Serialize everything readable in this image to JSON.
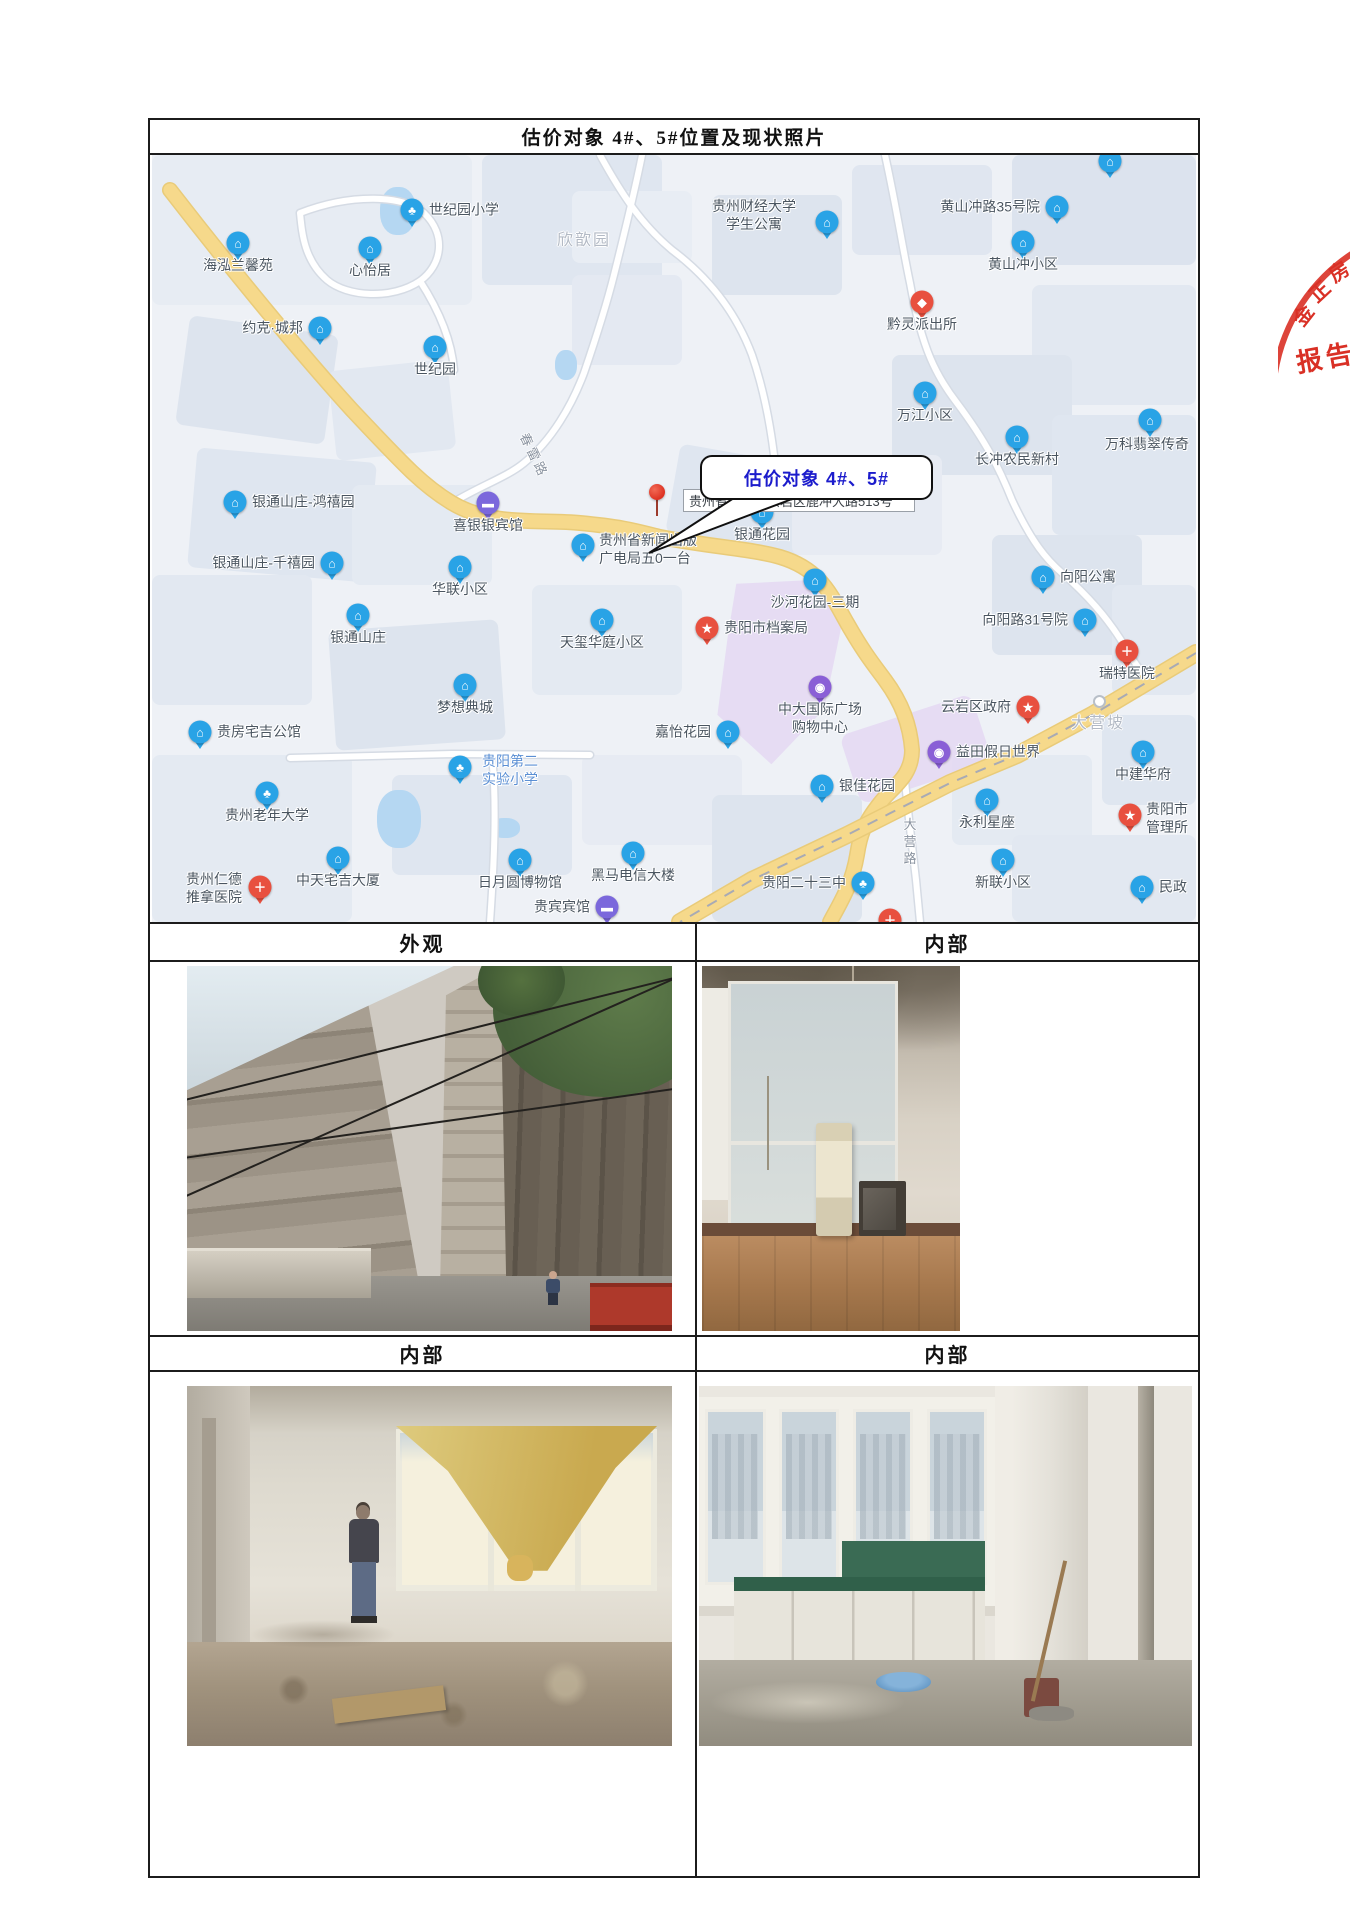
{
  "title": "估价对象 4#、5#位置及现状照片",
  "photo_sections": [
    {
      "label": "外观"
    },
    {
      "label": "内部"
    },
    {
      "label": "内部"
    },
    {
      "label": "内部"
    }
  ],
  "map": {
    "callout_text": "估价对象 4#、5#",
    "address_label": "贵州省贵阳市云岩区鹿冲大路513号",
    "area_labels": [
      {
        "text": "欣歆园",
        "x": 432,
        "y": 83
      },
      {
        "text": "大营坡",
        "x": 946,
        "y": 566
      }
    ],
    "road_labels": [
      {
        "text": "春雷路",
        "x": 383,
        "y": 300,
        "rotate": 64
      },
      {
        "text": "大营路",
        "x": 757,
        "y": 688,
        "vertical": true
      }
    ],
    "pois": [
      {
        "t": "世纪园小学",
        "icon": "tree",
        "x": 260,
        "y": 55,
        "lp": "right"
      },
      {
        "t": "海泓兰馨苑",
        "icon": "house",
        "x": 86,
        "y": 88,
        "lp": "below"
      },
      {
        "t": "心怡居",
        "icon": "house",
        "x": 218,
        "y": 93,
        "lp": "below"
      },
      {
        "t": "约克·城邦",
        "icon": "house",
        "x": 168,
        "y": 173,
        "lp": "left"
      },
      {
        "t": "世纪园",
        "icon": "house",
        "x": 283,
        "y": 192,
        "lp": "below"
      },
      {
        "t": "贵州财经大学\n学生公寓",
        "icon": "house",
        "x": 675,
        "y": 67,
        "lp": "custom",
        "lx": 560,
        "ly": 43,
        "la": "center"
      },
      {
        "t": "黄山冲路35号院",
        "icon": "house",
        "x": 905,
        "y": 52,
        "lp": "left"
      },
      {
        "t": "黄山冲小区",
        "icon": "house",
        "x": 871,
        "y": 87,
        "lp": "below"
      },
      {
        "t": "黔灵派出所",
        "icon": "badge",
        "x": 770,
        "y": 147,
        "lp": "below"
      },
      {
        "t": "万江小区",
        "icon": "house",
        "x": 773,
        "y": 238,
        "lp": "below"
      },
      {
        "t": "长冲农民新村",
        "icon": "house",
        "x": 865,
        "y": 282,
        "lp": "below"
      },
      {
        "t": "万科翡翠传奇",
        "icon": "house",
        "x": 998,
        "y": 265,
        "lp": "custom",
        "lx": 953,
        "ly": 281
      },
      {
        "t": "向阳公寓",
        "icon": "house",
        "x": 891,
        "y": 422,
        "lp": "right"
      },
      {
        "t": "向阳路31号院",
        "icon": "house",
        "x": 933,
        "y": 465,
        "lp": "left"
      },
      {
        "t": "瑞特医院",
        "icon": "cross",
        "x": 975,
        "y": 496,
        "lp": "below"
      },
      {
        "t": "云岩区政府",
        "icon": "star",
        "x": 876,
        "y": 552,
        "lp": "left"
      },
      {
        "t": "益田假日世界",
        "icon": "mall",
        "x": 787,
        "y": 597,
        "lp": "right"
      },
      {
        "t": "中建华府",
        "icon": "house",
        "x": 991,
        "y": 597,
        "lp": "below"
      },
      {
        "t": "银佳花园",
        "icon": "house",
        "x": 670,
        "y": 631,
        "lp": "right"
      },
      {
        "t": "永利星座",
        "icon": "house",
        "x": 835,
        "y": 645,
        "lp": "below"
      },
      {
        "t": "贵阳市\n管理所",
        "icon": "star",
        "x": 978,
        "y": 660,
        "lp": "custom",
        "lx": 994,
        "ly": 646
      },
      {
        "t": "新联小区",
        "icon": "house",
        "x": 851,
        "y": 705,
        "lp": "below"
      },
      {
        "t": "民政",
        "icon": "house",
        "x": 990,
        "y": 732,
        "lp": "right"
      },
      {
        "t": "沙河花园-三期",
        "icon": "house",
        "x": 663,
        "y": 425,
        "lp": "below"
      },
      {
        "t": "贵阳市档案局",
        "icon": "star",
        "x": 555,
        "y": 473,
        "lp": "right"
      },
      {
        "t": "天玺华庭小区",
        "icon": "house",
        "x": 450,
        "y": 465,
        "lp": "below"
      },
      {
        "t": "中大国际广场\n购物中心",
        "icon": "mall",
        "x": 668,
        "y": 532,
        "lp": "below"
      },
      {
        "t": "嘉怡花园",
        "icon": "house",
        "x": 576,
        "y": 577,
        "lp": "left"
      },
      {
        "t": "银通花园",
        "icon": "house",
        "x": 610,
        "y": 357,
        "lp": "below"
      },
      {
        "t": "贵州省新闻出版\n广电局五0一台",
        "icon": "house",
        "x": 431,
        "y": 390,
        "lp": "custom",
        "lx": 447,
        "ly": 377
      },
      {
        "t": "喜银银宾馆",
        "icon": "bed",
        "x": 336,
        "y": 348,
        "lp": "below"
      },
      {
        "t": "银通山庄-鸿禧园",
        "icon": "house",
        "x": 83,
        "y": 347,
        "lp": "right"
      },
      {
        "t": "银通山庄-千禧园",
        "icon": "house",
        "x": 180,
        "y": 408,
        "lp": "left"
      },
      {
        "t": "华联小区",
        "icon": "house",
        "x": 308,
        "y": 412,
        "lp": "below"
      },
      {
        "t": "银通山庄",
        "icon": "house",
        "x": 206,
        "y": 460,
        "lp": "below"
      },
      {
        "t": "梦想典城",
        "icon": "house",
        "x": 313,
        "y": 530,
        "lp": "below"
      },
      {
        "t": "贵房宅吉公馆",
        "icon": "house",
        "x": 48,
        "y": 577,
        "lp": "right"
      },
      {
        "t": "贵阳第二\n实验小学",
        "icon": "tree",
        "x": 308,
        "y": 612,
        "lp": "custom",
        "lx": 330,
        "ly": 598,
        "lc": "#5b8fd4"
      },
      {
        "t": "贵州老年大学",
        "icon": "tree",
        "x": 115,
        "y": 638,
        "lp": "below"
      },
      {
        "t": "贵州仁德\n推拿医院",
        "icon": "cross",
        "x": 108,
        "y": 732,
        "lp": "custom",
        "lx": 34,
        "ly": 716,
        "la": "left"
      },
      {
        "t": "中天宅吉大厦",
        "icon": "house",
        "x": 186,
        "y": 703,
        "lp": "below"
      },
      {
        "t": "日月圆博物馆",
        "icon": "museum",
        "x": 368,
        "y": 705,
        "lp": "below"
      },
      {
        "t": "黑马电信大楼",
        "icon": "house",
        "x": 481,
        "y": 698,
        "lp": "below"
      },
      {
        "t": "贵宾宾馆",
        "icon": "bed",
        "x": 455,
        "y": 752,
        "lp": "left"
      },
      {
        "t": "贵阳二十三中",
        "icon": "tree",
        "x": 711,
        "y": 728,
        "lp": "left"
      },
      {
        "t": "",
        "icon": "cross",
        "x": 738,
        "y": 765,
        "lp": "none"
      },
      {
        "t": "",
        "icon": "house",
        "x": 958,
        "y": 6,
        "lp": "none"
      }
    ]
  },
  "stamp": {
    "arc_chars": [
      "金",
      "正",
      "房"
    ],
    "banner_text": "报告"
  },
  "colors": {
    "poi_blue": "#29a3e6",
    "poi_red": "#e8503f",
    "poi_purple": "#7b68dc",
    "poi_mall": "#8a5fd6",
    "road_yellow": "#f6d98b",
    "water": "#b5d7f2",
    "purple_zone": "#e3d7f2",
    "callout_text": "#1c1ccc",
    "stamp_red": "#d93025",
    "label_default": "#4a5560"
  }
}
